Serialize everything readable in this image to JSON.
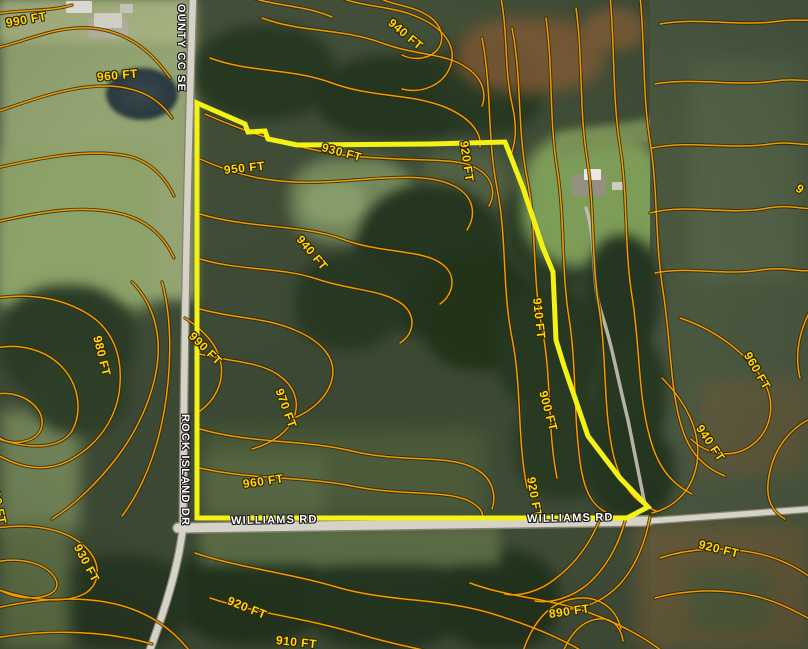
{
  "map": {
    "description": "Aerial parcel map with topographic contour overlay",
    "elevation_unit": "FT",
    "colors": {
      "contour_line": "#ef9b06",
      "contour_label": "#ffd712",
      "parcel_boundary": "#f3f214",
      "road_fill": "#d5d2c8",
      "road_label": "#ffffff"
    },
    "parcel_boundary": {
      "points": [
        [
          197,
          103
        ],
        [
          245,
          124
        ],
        [
          248,
          132
        ],
        [
          265,
          131
        ],
        [
          268,
          139
        ],
        [
          297,
          145
        ],
        [
          430,
          144
        ],
        [
          505,
          142
        ],
        [
          523,
          188
        ],
        [
          543,
          248
        ],
        [
          553,
          272
        ],
        [
          556,
          340
        ],
        [
          564,
          366
        ],
        [
          588,
          436
        ],
        [
          620,
          478
        ],
        [
          648,
          507
        ],
        [
          627,
          518
        ],
        [
          197,
          518
        ]
      ]
    },
    "contour_labels": [
      {
        "text": "990 FT",
        "x": 6,
        "y": 16,
        "rot": -10
      },
      {
        "text": "960 FT",
        "x": 97,
        "y": 70,
        "rot": -5
      },
      {
        "text": "940 FT",
        "x": 390,
        "y": 14,
        "rot": 40
      },
      {
        "text": "930 FT",
        "x": 322,
        "y": 140,
        "rot": 15
      },
      {
        "text": "920 FT",
        "x": 464,
        "y": 134,
        "rot": 82
      },
      {
        "text": "950 FT",
        "x": 224,
        "y": 163,
        "rot": -6
      },
      {
        "text": "940 FT",
        "x": 299,
        "y": 230,
        "rot": 50
      },
      {
        "text": "990 FT",
        "x": 191,
        "y": 327,
        "rot": 45
      },
      {
        "text": "980 FT",
        "x": 97,
        "y": 329,
        "rot": 76
      },
      {
        "text": "970 FT",
        "x": 279,
        "y": 382,
        "rot": 70
      },
      {
        "text": "910 FT",
        "x": 537,
        "y": 291,
        "rot": 84
      },
      {
        "text": "900 FT",
        "x": 543,
        "y": 384,
        "rot": 75
      },
      {
        "text": "920 FT",
        "x": 531,
        "y": 470,
        "rot": 80
      },
      {
        "text": "960 FT",
        "x": -6,
        "y": 477,
        "rot": 78
      },
      {
        "text": "930 FT",
        "x": 77,
        "y": 538,
        "rot": 62
      },
      {
        "text": "960 FT",
        "x": 243,
        "y": 477,
        "rot": -8
      },
      {
        "text": "920 FT",
        "x": 228,
        "y": 593,
        "rot": 22
      },
      {
        "text": "910 FT",
        "x": 276,
        "y": 633,
        "rot": 6
      },
      {
        "text": "890 FT",
        "x": 549,
        "y": 607,
        "rot": -8
      },
      {
        "text": "920 FT",
        "x": 699,
        "y": 537,
        "rot": 14
      },
      {
        "text": "940 FT",
        "x": 699,
        "y": 419,
        "rot": 56
      },
      {
        "text": "960 FT",
        "x": 747,
        "y": 346,
        "rot": 60
      },
      {
        "text": "9",
        "x": 797,
        "y": 180,
        "rot": 35
      }
    ],
    "road_labels": [
      {
        "text": "OUNTY CC SE",
        "x": 187,
        "y": 4,
        "rot": 90
      },
      {
        "text": "ROCK ISLAND DR",
        "x": 191,
        "y": 414,
        "rot": 90
      },
      {
        "text": "WILLIAMS RD",
        "x": 231,
        "y": 515,
        "rot": -1
      },
      {
        "text": "WILLIAMS RD",
        "x": 527,
        "y": 513,
        "rot": -1
      }
    ]
  }
}
